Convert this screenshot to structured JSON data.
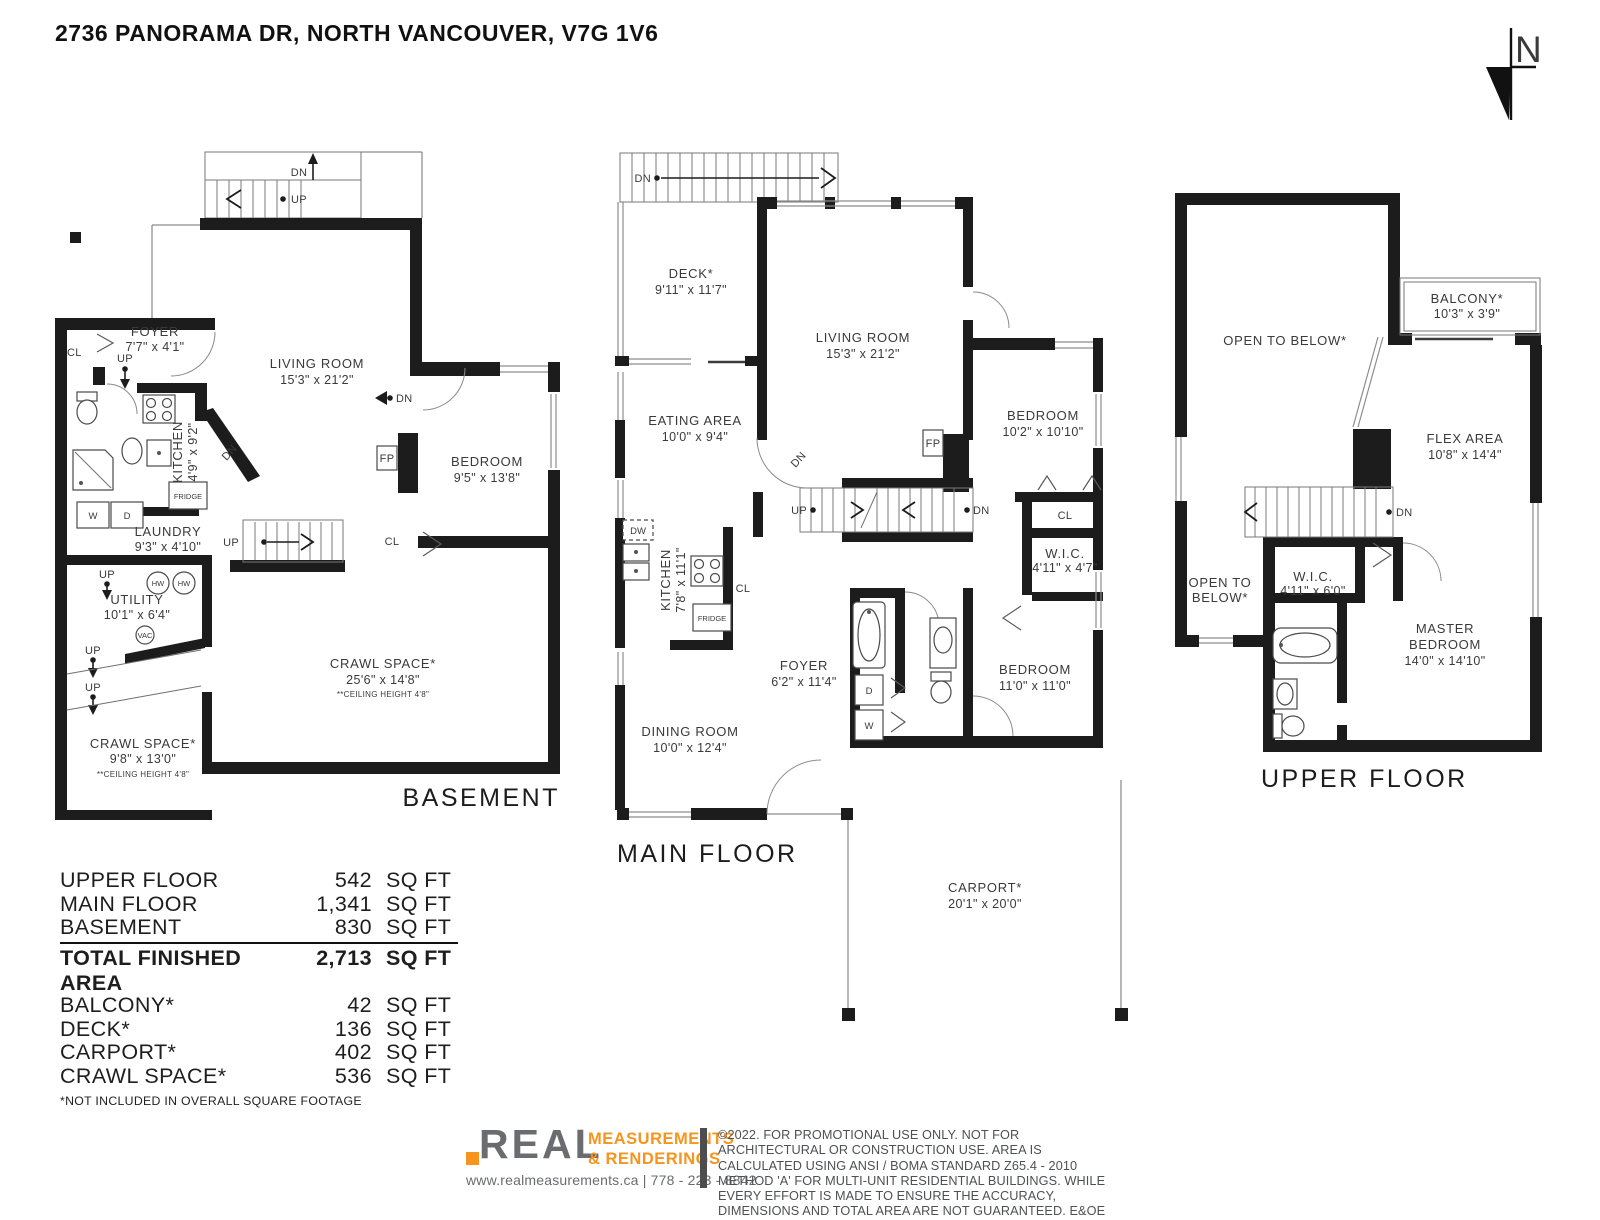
{
  "title": "2736 PANORAMA DR, NORTH VANCOUVER, V7G 1V6",
  "north": {
    "label": "N"
  },
  "markers": {
    "up": "UP",
    "dn": "DN",
    "cl": "CL",
    "fp": "FP",
    "dw": "DW",
    "w": "W",
    "d": "D",
    "hw": "HW",
    "vac": "VAC",
    "fridge": "FRIDGE"
  },
  "floors": {
    "basement": {
      "name": "BASEMENT",
      "rooms": {
        "foyer": {
          "name": "FOYER",
          "dims": "7'7\" x 4'1\""
        },
        "living": {
          "name": "LIVING ROOM",
          "dims": "15'3\" x 21'2\""
        },
        "kitchen": {
          "name": "KITCHEN",
          "dims": "4'9\" x 9'2\""
        },
        "bedroom": {
          "name": "BEDROOM",
          "dims": "9'5\" x 13'8\""
        },
        "laundry": {
          "name": "LAUNDRY",
          "dims": "9'3\" x 4'10\""
        },
        "utility": {
          "name": "UTILITY",
          "dims": "10'1\" x 6'4\""
        },
        "crawl_large": {
          "name": "CRAWL SPACE*",
          "dims": "25'6\" x 14'8\"",
          "note": "**CEILING HEIGHT 4'8\""
        },
        "crawl_small": {
          "name": "CRAWL SPACE*",
          "dims": "9'8\" x 13'0\"",
          "note": "**CEILING HEIGHT 4'8\""
        }
      }
    },
    "main": {
      "name": "MAIN FLOOR",
      "rooms": {
        "deck": {
          "name": "DECK*",
          "dims": "9'11\" x 11'7\""
        },
        "living": {
          "name": "LIVING ROOM",
          "dims": "15'3\" x 21'2\""
        },
        "eating": {
          "name": "EATING AREA",
          "dims": "10'0\" x 9'4\""
        },
        "kitchen": {
          "name": "KITCHEN",
          "dims": "7'8\" x 11'1\""
        },
        "bedroom_upper": {
          "name": "BEDROOM",
          "dims": "10'2\" x 10'10\""
        },
        "wic": {
          "name": "W.I.C.",
          "dims": "4'11\" x 4'7\""
        },
        "foyer": {
          "name": "FOYER",
          "dims": "6'2\" x 11'4\""
        },
        "bedroom_lower": {
          "name": "BEDROOM",
          "dims": "11'0\" x 11'0\""
        },
        "dining": {
          "name": "DINING ROOM",
          "dims": "10'0\" x 12'4\""
        },
        "carport": {
          "name": "CARPORT*",
          "dims": "20'1\" x 20'0\""
        }
      }
    },
    "upper": {
      "name": "UPPER FLOOR",
      "rooms": {
        "open_below": {
          "name": "OPEN TO BELOW*"
        },
        "open_below_small": {
          "line1": "OPEN TO",
          "line2": "BELOW*"
        },
        "balcony": {
          "name": "BALCONY*",
          "dims": "10'3\" x 3'9\""
        },
        "flex": {
          "name": "FLEX AREA",
          "dims": "10'8\" x 14'4\""
        },
        "wic": {
          "name": "W.I.C.",
          "dims": "4'11\" x 6'0\""
        },
        "master": {
          "line1": "MASTER",
          "line2": "BEDROOM",
          "dims": "14'0\" x 14'10\""
        }
      }
    }
  },
  "area_table": {
    "rows": [
      {
        "label": "UPPER FLOOR",
        "value": "542",
        "unit": "SQ FT"
      },
      {
        "label": "MAIN FLOOR",
        "value": "1,341",
        "unit": "SQ FT"
      },
      {
        "label": "BASEMENT",
        "value": "830",
        "unit": "SQ FT"
      }
    ],
    "total": {
      "label": "TOTAL FINISHED AREA",
      "value": "2,713",
      "unit": "SQ FT"
    },
    "excluded": [
      {
        "label": "BALCONY*",
        "value": "42",
        "unit": "SQ FT"
      },
      {
        "label": "DECK*",
        "value": "136",
        "unit": "SQ FT"
      },
      {
        "label": "CARPORT*",
        "value": "402",
        "unit": "SQ FT"
      },
      {
        "label": "CRAWL SPACE*",
        "value": "536",
        "unit": "SQ FT"
      }
    ],
    "footnote": "*NOT INCLUDED IN OVERALL SQUARE FOOTAGE"
  },
  "footer": {
    "logo_word": "REAL",
    "logo_line1": "MEASUREMENTS",
    "logo_line2": "& RENDERINGS",
    "contact": "www.realmeasurements.ca | 778 - 223 - 8842",
    "disclaimer": "©2022. FOR PROMOTIONAL USE ONLY. NOT FOR ARCHITECTURAL OR CONSTRUCTION USE. AREA IS CALCULATED USING ANSI / BOMA STANDARD Z65.4 - 2010 METHOD 'A' FOR MULTI-UNIT RESIDENTIAL BUILDINGS. WHILE EVERY EFFORT IS MADE TO ENSURE THE ACCURACY, DIMENSIONS AND TOTAL AREA ARE NOT GUARANTEED. E&OE"
  },
  "colors": {
    "wall": "#1c1c1c",
    "accent_orange": "#f7941d",
    "logo_gray": "#6b6c6f"
  }
}
